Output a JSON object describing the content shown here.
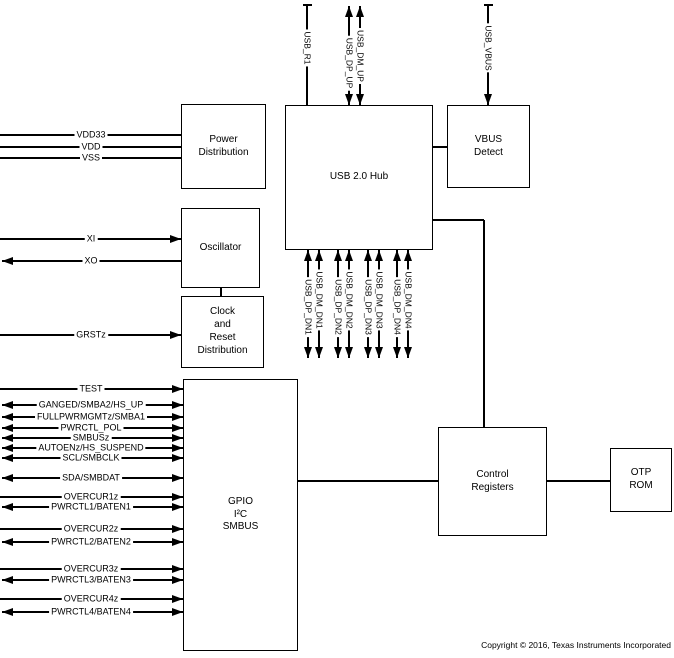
{
  "diagram": {
    "title": "USB 2.0 Hub functional block diagram",
    "copyright": "Copyright © 2016, Texas Instruments Incorporated",
    "colors": {
      "line": "#000000",
      "background": "#ffffff",
      "text": "#000000"
    },
    "blocks": [
      {
        "id": "power-distribution",
        "label": "Power\nDistribution",
        "x": 181,
        "y": 104,
        "w": 85,
        "h": 85
      },
      {
        "id": "oscillator",
        "label": "Oscillator",
        "x": 181,
        "y": 208,
        "w": 79,
        "h": 80
      },
      {
        "id": "clock-reset-distribution",
        "label": "Clock\nand\nReset\nDistribution",
        "x": 181,
        "y": 296,
        "w": 83,
        "h": 72
      },
      {
        "id": "gpio-i2c-smbus",
        "label": "GPIO\nI²C\nSMBUS",
        "x": 183,
        "y": 379,
        "w": 115,
        "h": 272
      },
      {
        "id": "usb-hub",
        "label": "USB 2.0 Hub",
        "x": 285,
        "y": 105,
        "w": 148,
        "h": 145
      },
      {
        "id": "vbus-detect",
        "label": "VBUS\nDetect",
        "x": 447,
        "y": 105,
        "w": 83,
        "h": 83
      },
      {
        "id": "control-registers",
        "label": "Control\nRegisters",
        "x": 438,
        "y": 427,
        "w": 109,
        "h": 109
      },
      {
        "id": "otp-rom",
        "label": "OTP\nROM",
        "x": 610,
        "y": 448,
        "w": 62,
        "h": 64
      }
    ],
    "left_signals": [
      {
        "id": "vdd33",
        "label": "VDD33",
        "y": 135,
        "x_end": 181,
        "arrows": "none"
      },
      {
        "id": "vdd",
        "label": "VDD",
        "y": 147,
        "x_end": 181,
        "arrows": "none"
      },
      {
        "id": "vss",
        "label": "VSS",
        "y": 158,
        "x_end": 181,
        "arrows": "none"
      },
      {
        "id": "xi",
        "label": "XI",
        "y": 239,
        "x_end": 181,
        "arrows": "right"
      },
      {
        "id": "xo",
        "label": "XO",
        "y": 261,
        "x_end": 181,
        "arrows": "left"
      },
      {
        "id": "grstz",
        "label": "GRSTz",
        "y": 335,
        "x_end": 181,
        "arrows": "right"
      },
      {
        "id": "test",
        "label": "TEST",
        "y": 389,
        "x_end": 183,
        "arrows": "right"
      },
      {
        "id": "ganged",
        "label": "GANGED/SMBA2/HS_UP",
        "y": 405,
        "x_end": 183,
        "arrows": "double"
      },
      {
        "id": "fullpwrmgmtz",
        "label": "FULLPWRMGMTz/SMBA1",
        "y": 417,
        "x_end": 183,
        "arrows": "double"
      },
      {
        "id": "pwrctl-pol",
        "label": "PWRCTL_POL",
        "y": 428,
        "x_end": 183,
        "arrows": "double"
      },
      {
        "id": "smbusz",
        "label": "SMBUSz",
        "y": 438,
        "x_end": 183,
        "arrows": "double"
      },
      {
        "id": "autoenz",
        "label": "AUTOENz/HS_SUSPEND",
        "y": 448,
        "x_end": 183,
        "arrows": "double"
      },
      {
        "id": "scl-smbclk",
        "label": "SCL/SMBCLK",
        "y": 458,
        "x_end": 183,
        "arrows": "double"
      },
      {
        "id": "sda-smbdat",
        "label": "SDA/SMBDAT",
        "y": 478,
        "x_end": 183,
        "arrows": "double"
      },
      {
        "id": "overcur1z",
        "label": "OVERCUR1z",
        "y": 497,
        "x_end": 183,
        "arrows": "right"
      },
      {
        "id": "pwrctl1",
        "label": "PWRCTL1/BATEN1",
        "y": 507,
        "x_end": 183,
        "arrows": "double"
      },
      {
        "id": "overcur2z",
        "label": "OVERCUR2z",
        "y": 529,
        "x_end": 183,
        "arrows": "right"
      },
      {
        "id": "pwrctl2",
        "label": "PWRCTL2/BATEN2",
        "y": 542,
        "x_end": 183,
        "arrows": "double"
      },
      {
        "id": "overcur3z",
        "label": "OVERCUR3z",
        "y": 569,
        "x_end": 183,
        "arrows": "right"
      },
      {
        "id": "pwrctl3",
        "label": "PWRCTL3/BATEN3",
        "y": 580,
        "x_end": 183,
        "arrows": "double"
      },
      {
        "id": "overcur4z",
        "label": "OVERCUR4z",
        "y": 599,
        "x_end": 183,
        "arrows": "right"
      },
      {
        "id": "pwrctl4",
        "label": "PWRCTL4/BATEN4",
        "y": 612,
        "x_end": 183,
        "arrows": "double"
      }
    ],
    "label_center_x": 91,
    "vertical_signals": [
      {
        "id": "usb-r1",
        "label": "USB_R1",
        "x": 307,
        "y1": 5,
        "y2": 105,
        "label_y": 48,
        "arrows": "none",
        "tick": true
      },
      {
        "id": "usb-dp-up",
        "label": "USB_DP_UP",
        "x": 349,
        "y1": 6,
        "y2": 105,
        "label_y": 63,
        "arrows": "double",
        "tick": false
      },
      {
        "id": "usb-dm-up",
        "label": "USB_DM_UP",
        "x": 360,
        "y1": 6,
        "y2": 105,
        "label_y": 56,
        "arrows": "double",
        "tick": false
      },
      {
        "id": "usb-vbus",
        "label": "USB_VBUS",
        "x": 488,
        "y1": 5,
        "y2": 105,
        "label_y": 48,
        "arrows": "down",
        "tick": true
      },
      {
        "id": "usb-dp-dn1",
        "label": "USB_DP_DN1",
        "x": 308,
        "y1": 250,
        "y2": 358,
        "label_y": 307,
        "arrows": "double",
        "tick": false
      },
      {
        "id": "usb-dm-dn1",
        "label": "USB_DM_DN1",
        "x": 319,
        "y1": 250,
        "y2": 358,
        "label_y": 300,
        "arrows": "double",
        "tick": false
      },
      {
        "id": "usb-dp-dn2",
        "label": "USB_DP_DN2",
        "x": 338,
        "y1": 250,
        "y2": 358,
        "label_y": 307,
        "arrows": "double",
        "tick": false
      },
      {
        "id": "usb-dm-dn2",
        "label": "USB_DM_DN2",
        "x": 349,
        "y1": 250,
        "y2": 358,
        "label_y": 300,
        "arrows": "double",
        "tick": false
      },
      {
        "id": "usb-dp-dn3",
        "label": "USB_DP_DN3",
        "x": 368,
        "y1": 250,
        "y2": 358,
        "label_y": 307,
        "arrows": "double",
        "tick": false
      },
      {
        "id": "usb-dm-dn3",
        "label": "USB_DM_DN3",
        "x": 379,
        "y1": 250,
        "y2": 358,
        "label_y": 300,
        "arrows": "double",
        "tick": false
      },
      {
        "id": "usb-dp-dn4",
        "label": "USB_DP_DN4",
        "x": 397,
        "y1": 250,
        "y2": 358,
        "label_y": 307,
        "arrows": "double",
        "tick": false
      },
      {
        "id": "usb-dm-dn4",
        "label": "USB_DM_DN4",
        "x": 408,
        "y1": 250,
        "y2": 358,
        "label_y": 300,
        "arrows": "double",
        "tick": false
      }
    ],
    "connectors": [
      {
        "id": "hub-to-vbus-detect",
        "dir": "h",
        "x": 433,
        "y": 147,
        "len": 14
      },
      {
        "id": "hub-to-control-horizontal",
        "dir": "h",
        "x": 433,
        "y": 220,
        "len": 51
      },
      {
        "id": "hub-to-control-vertical",
        "dir": "v",
        "x": 484,
        "y": 220,
        "len": 207
      },
      {
        "id": "gpio-to-control",
        "dir": "h",
        "x": 298,
        "y": 481,
        "len": 140
      },
      {
        "id": "control-to-otp",
        "dir": "h",
        "x": 547,
        "y": 481,
        "len": 63
      },
      {
        "id": "oscillator-to-clock",
        "dir": "v",
        "x": 221,
        "y": 288,
        "len": 8
      }
    ]
  }
}
